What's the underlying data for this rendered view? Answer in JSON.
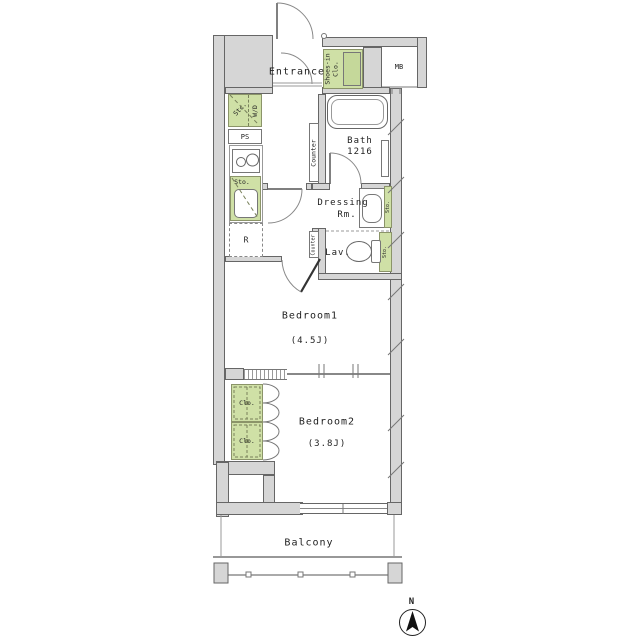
{
  "floorplan": {
    "rooms": {
      "entrance": "Entrance",
      "bath": "Bath",
      "bath_size": "1216",
      "dressing_line1": "Dressing",
      "dressing_line2": "Rm.",
      "lavatory": "Lav.",
      "bedroom1": "Bedroom1",
      "bedroom1_size": "(4.5J)",
      "bedroom2": "Bedroom2",
      "bedroom2_size": "(3.8J)",
      "balcony": "Balcony"
    },
    "storage": {
      "shoes_closet_line1": "Shoes-in",
      "shoes_closet_line2": "Clo.",
      "storage_compact": "Stc.",
      "washer_dryer": "W/D",
      "pipe_space": "PS",
      "counter": "Counter",
      "kitchen_storage": "Sto.",
      "washstand_storage": "Sto.",
      "lavatory_storage": "Sto.",
      "closet_upper": "Clo.",
      "closet_lower": "Clo.",
      "meter_box": "MB",
      "refrigerator": "R"
    },
    "compass": {
      "north": "N"
    },
    "colors": {
      "storage_green": "#cfe0a6",
      "wall_gray": "#d6d6d6",
      "line": "#555555"
    }
  }
}
